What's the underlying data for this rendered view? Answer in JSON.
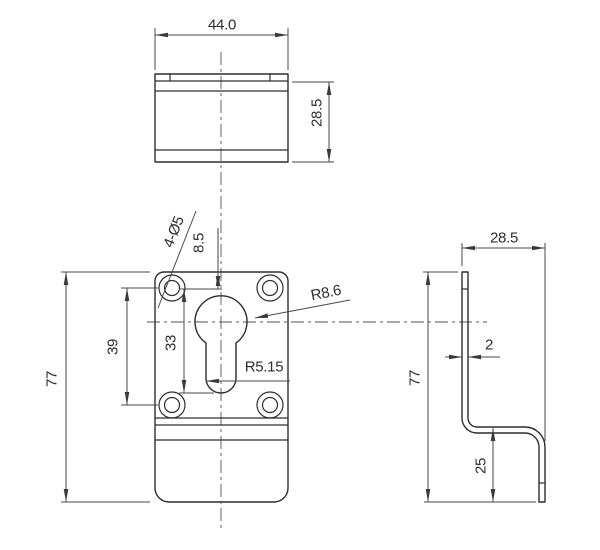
{
  "views": {
    "top": {
      "width": "44.0",
      "depth": "28.5"
    },
    "front": {
      "height": "77",
      "hole_spacing": "39",
      "slot_length": "33",
      "edge_offset": "8.5",
      "holes": "4-Ø5",
      "bulge_radius": "R8.6",
      "slot_radius": "R5.15"
    },
    "side": {
      "depth": "28.5",
      "height": "77",
      "thickness": "2",
      "flange_height": "25"
    }
  },
  "colors": {
    "background": "#ffffff",
    "outline": "#2e2e2e",
    "dimension": "#4a4a4a",
    "centerline": "#565656"
  }
}
